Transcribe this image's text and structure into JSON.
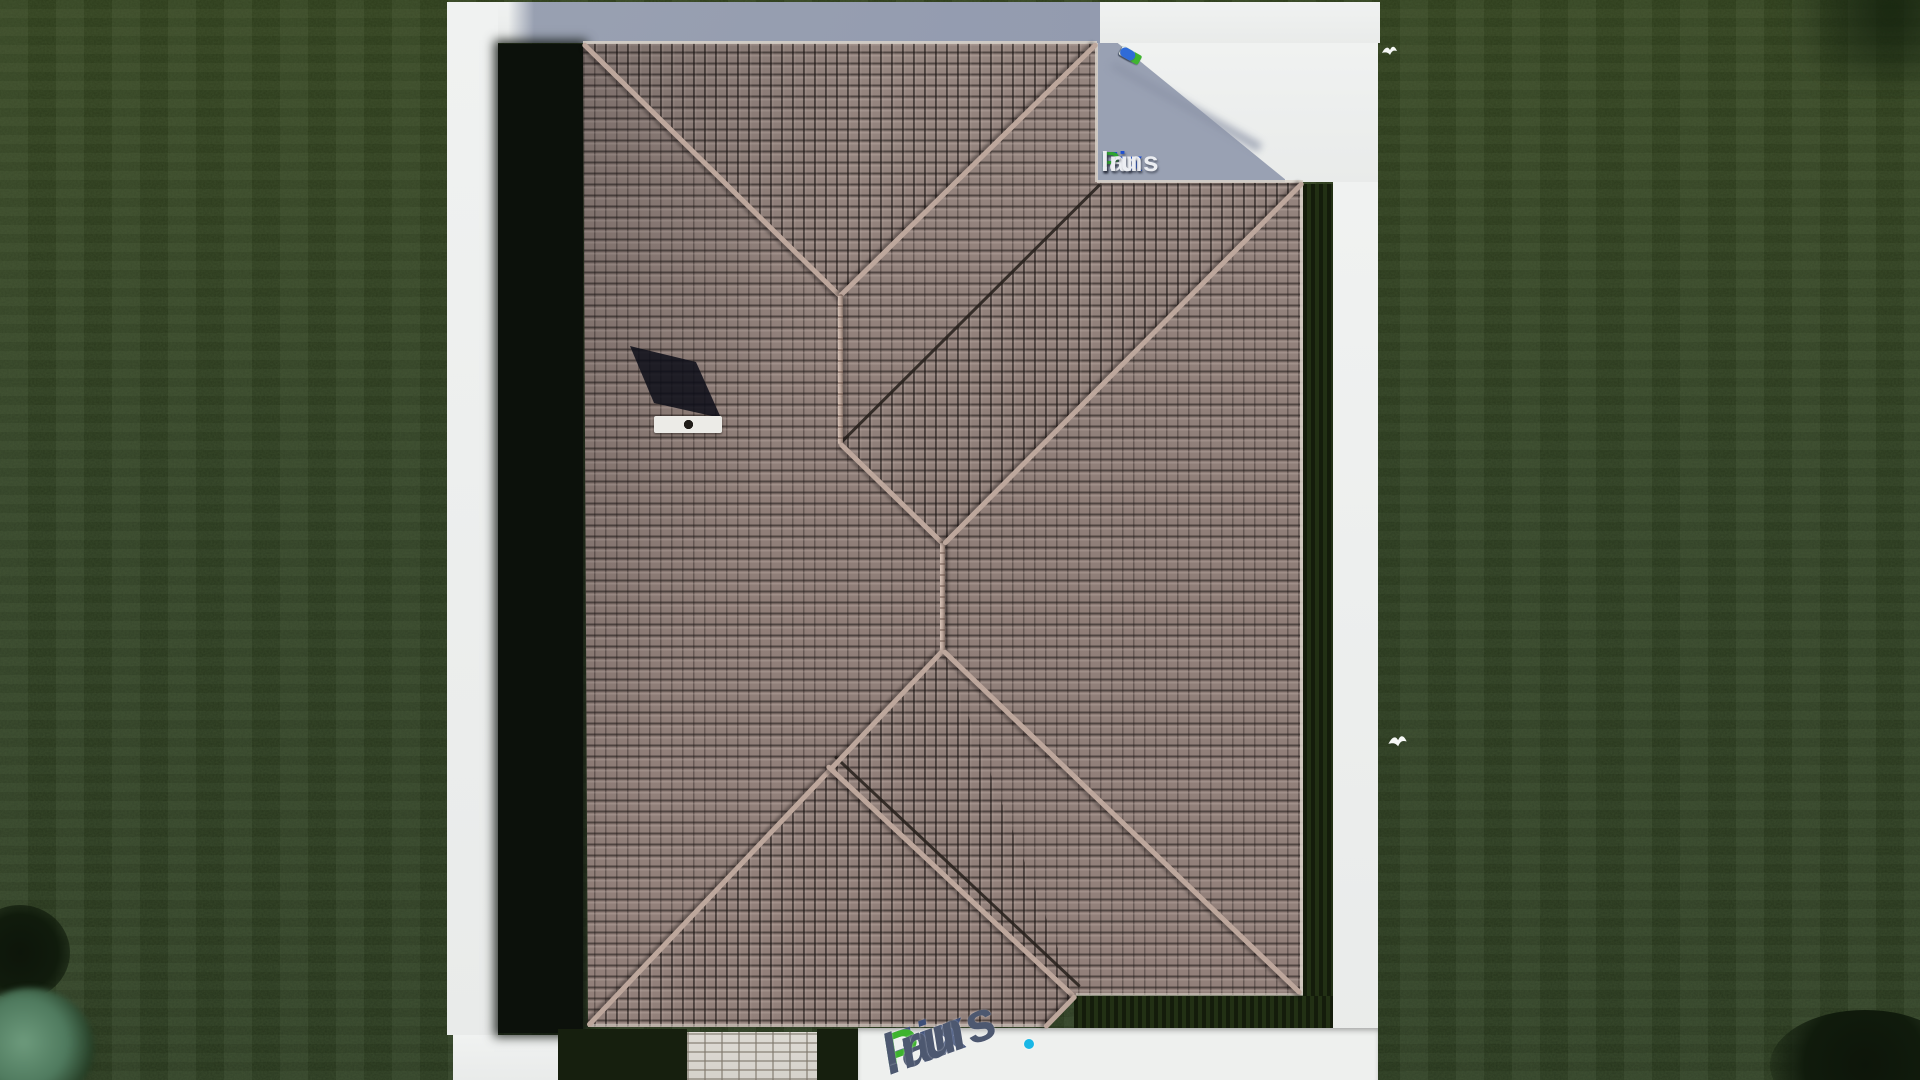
{
  "watermark": {
    "fix": "Fix",
    "p": "P",
    "lans": "lans",
    "dot_ru": ".ru",
    "full": "FixPlans.ru"
  },
  "scene": {
    "view": "top-down aerial render of a house with hip tile roof",
    "elements": [
      "lawn",
      "white-path-frame",
      "tile-roof",
      "chimney",
      "chimney-shadow",
      "paver-walkway",
      "terrace",
      "hedge-strips",
      "white-birds",
      "bushes",
      "watermark-logo-top",
      "watermark-tape",
      "watermark-logo-bottom"
    ]
  },
  "colors": {
    "lawn": "#2e3d22",
    "lawn_shadow": "#0c110b",
    "path_white": "#eef0ef",
    "path_shadow_blue": "#939baf",
    "roof_tile": "#8f7e78",
    "roof_gap": "#3f3733",
    "ridge_tile": "#bda79c",
    "valley": "#241f1a",
    "paver": "#d8d5cf",
    "chimney": "#ecebe7",
    "logo_blue": "#1d4fd0",
    "logo_green": "#2fa32f",
    "logo_light": "#eceef2",
    "bottom_logo_slate": "#4d5870",
    "tape_blue": "#2f6bd8",
    "tape_green": "#3fb52f",
    "cyan_dot": "#19b7e6",
    "bush_teal": "#5c8a6e"
  }
}
